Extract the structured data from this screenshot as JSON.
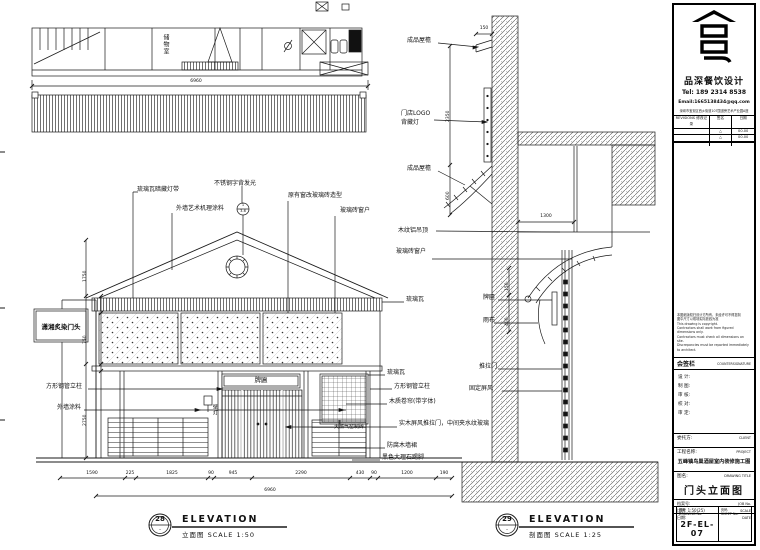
{
  "plan": {
    "room_label": "储物室",
    "dim_total": "6960"
  },
  "elevation": {
    "labels_top": [
      "琉璃瓦暗藏灯带",
      "外墙艺术机理涂料",
      "不锈钢字背发光",
      "原有窗改玻璃砖造型",
      "玻璃砖窗户"
    ],
    "labels_right": [
      "琉璃瓦",
      "琉璃瓦",
      "方形钢管立柱",
      "木质卷帘(带字体)",
      "实木屏风推拉门，中间夹水纹玻璃",
      "防腐木墙裙",
      "黑色大理石踢脚"
    ],
    "labels_left": [
      "方形钢管立柱",
      "外墙涂料"
    ],
    "label_plaque": "牌匾",
    "label_wall_lamp": "壁灯",
    "label_gas_brick": "天燃气窑制砖",
    "sign_text": "潇湘炙染门头",
    "marker_top": "1",
    "marker_bottom": "3-6",
    "dims_bottom": [
      "1590",
      "225",
      "1825",
      "90",
      "945",
      "2290",
      "430",
      "90",
      "1200",
      "190"
    ],
    "dim_total": "6960",
    "dims_left": [
      "1750",
      "750",
      "2750"
    ]
  },
  "section": {
    "labels": [
      "成品屋檐",
      "门店LOGO",
      "背藏灯",
      "成品屋檐",
      "木纹铝吊顶",
      "玻璃砖窗户",
      "牌匾",
      "雨布",
      "推拉门",
      "固定屏风"
    ],
    "dims": {
      "top": "150",
      "wall": "2350",
      "eave": "600",
      "ceiling": "1300",
      "plaque": "150",
      "banner": "400"
    }
  },
  "captions": {
    "left": {
      "number": "28",
      "dash": "-",
      "title": "ELEVATION",
      "subtitle": "立面图  SCALE 1:50"
    },
    "right": {
      "number": "29",
      "dash": "-",
      "title": "ELEVATION",
      "subtitle": "剖面图  SCALE 1:25"
    }
  },
  "titleblock": {
    "brand": "品深餐饮设计",
    "tel": "Tel: 189 2314 8538",
    "email": "Email:1665138434@qq.com",
    "address": "深圳市宝安区西乡街道107国道旁艺术产业园A座",
    "revisions": {
      "header_left": "REVISIONS 修改记录",
      "header_mid": "签名",
      "header_right": "日期",
      "rows": [
        {
          "mark": "△",
          "date": "00.00"
        },
        {
          "mark": "△",
          "date": "00.00"
        }
      ]
    },
    "notes": [
      "本图纸版权归设计方所有，未经许可不得复制",
      "图中尺寸以现场实际放线为准",
      "This drawing is copyright.",
      "Contractors shall work from figured dimensions only.",
      "Contractors must check all dimensions on site.",
      "Discrepancies must be reported immediately to architect."
    ],
    "countersign_cn": "会签栏",
    "countersign_en": "COUNTERSIGNATURE",
    "sign_fields": [
      "设 计:",
      "制 图:",
      "审 核:",
      "校 对:",
      "审 定:"
    ],
    "client_label": "委托方:",
    "client_en": "CLIENT",
    "project_label": "工程名称:",
    "project_en": "PROJECT",
    "project_name": "五峰镇鸟巢酒屋室内装修施工图",
    "drawing_title_label": "图名:",
    "drawing_title_en": "DRAWING TITLE",
    "drawing_title": "门头立面图",
    "job_label": "档案号:",
    "job_en": "JOB No.",
    "scale_label": "比例: 1:50(25)",
    "scale_en": "SCALE",
    "date_label": "日期:",
    "date_en": "DATE",
    "number_label": "图号",
    "number_en": "DRAWING No.",
    "number_value": "2F-EL-07",
    "sheet_label": "页码",
    "sheet_en": "SHEET No."
  }
}
